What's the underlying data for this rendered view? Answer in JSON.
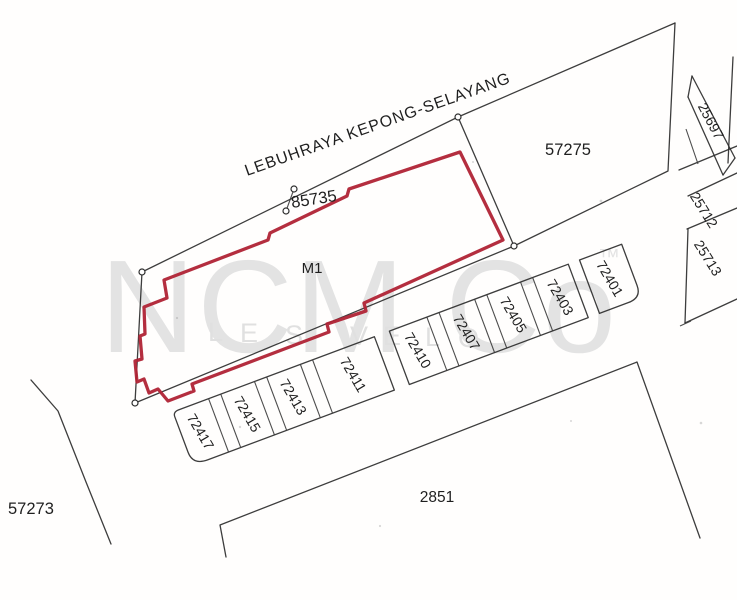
{
  "road": {
    "name": "LEBUHRAYA KEPONG-SELAYANG"
  },
  "highlight": {
    "lot_no": "85735",
    "unit_label": "M1",
    "color": "#b02335"
  },
  "parcels": {
    "p57275": "57275",
    "p57273": "57273",
    "p2851": "2851"
  },
  "strip_lots": [
    "72417",
    "72415",
    "72413",
    "72411",
    "72410",
    "72407",
    "72405",
    "72403",
    "72401"
  ],
  "side_lots": [
    "25697",
    "25712",
    "25713"
  ],
  "watermark": {
    "brand": "NCM Co",
    "tm": "™",
    "letters": [
      "L",
      "E",
      "S",
      "V",
      "E",
      "L",
      "O"
    ]
  }
}
